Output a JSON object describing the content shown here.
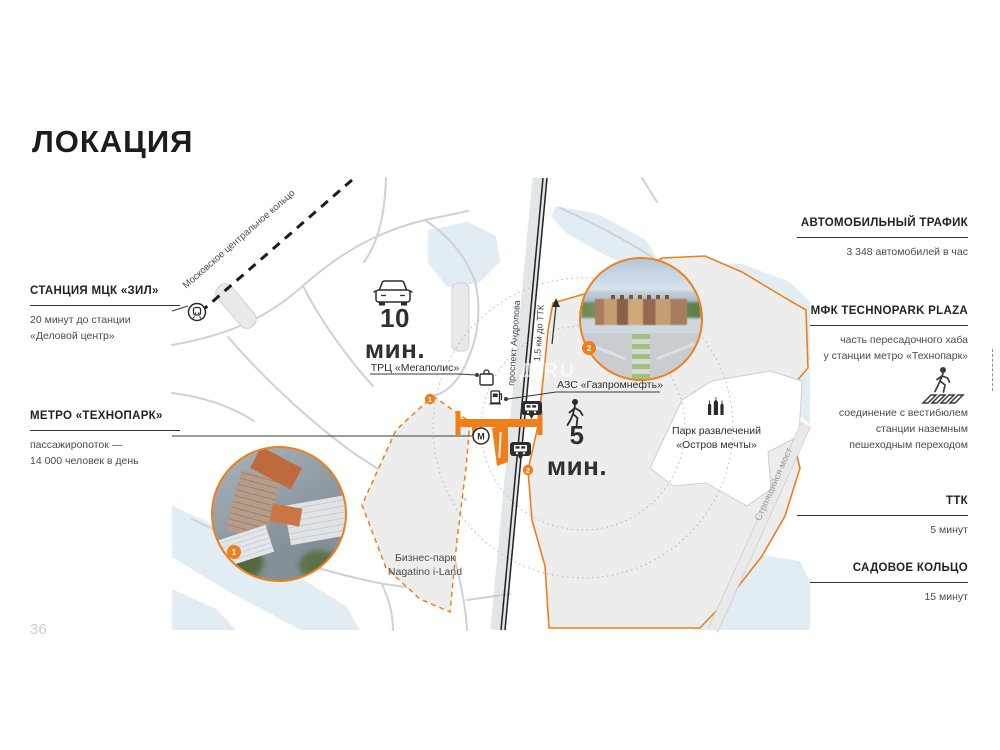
{
  "slide": {
    "title": "ЛОКАЦИЯ",
    "page_number": "36",
    "watermark": "ЗД.RU",
    "accent_color": "#EF7F1A"
  },
  "left_panel": {
    "mcc_station": {
      "title": "СТАНЦИЯ МЦК «ЗИЛ»",
      "line1": "20 минут до станции",
      "line2": "«Деловой центр»"
    },
    "metro": {
      "title": "МЕТРО «ТЕХНОПАРК»",
      "line1": "пассажиропоток —",
      "line2": "14 000 человек в день"
    }
  },
  "right_panel": {
    "traffic": {
      "title": "АВТОМОБИЛЬНЫЙ ТРАФИК",
      "value": "3 348 автомобилей в час"
    },
    "plaza": {
      "title": "МФК TECHNOPARK PLAZA",
      "line1": "часть пересадочного хаба",
      "line2": "у станции метро «Технопарк»"
    },
    "crossing": {
      "line1": "соединение с вестибюлем",
      "line2": "станции наземным",
      "line3": "пешеходным переходом"
    },
    "ttk": {
      "title": "ТТК",
      "value": "5 минут"
    },
    "garden_ring": {
      "title": "САДОВОЕ КОЛЬЦО",
      "value": "15 минут"
    }
  },
  "map": {
    "drive_time": "10 мин.",
    "walk_time": "5 мин.",
    "railway_label": "Московское центральное кольцо",
    "avenue_label": "проспект Андропова",
    "ttk_distance": "1,5 км до ТТК",
    "bridge_label": "Строящийся мост",
    "mall": "ТРЦ «Мегаполис»",
    "gas_station": "АЗС «Газпромнефть»",
    "park_line1": "Парк развлечений",
    "park_line2": "«Остров мечты»",
    "business_park_line1": "Бизнес-парк",
    "business_park_line2": "Nagatino i-Land",
    "marker_1": "1",
    "marker_2": "2",
    "metro_letter": "М"
  }
}
